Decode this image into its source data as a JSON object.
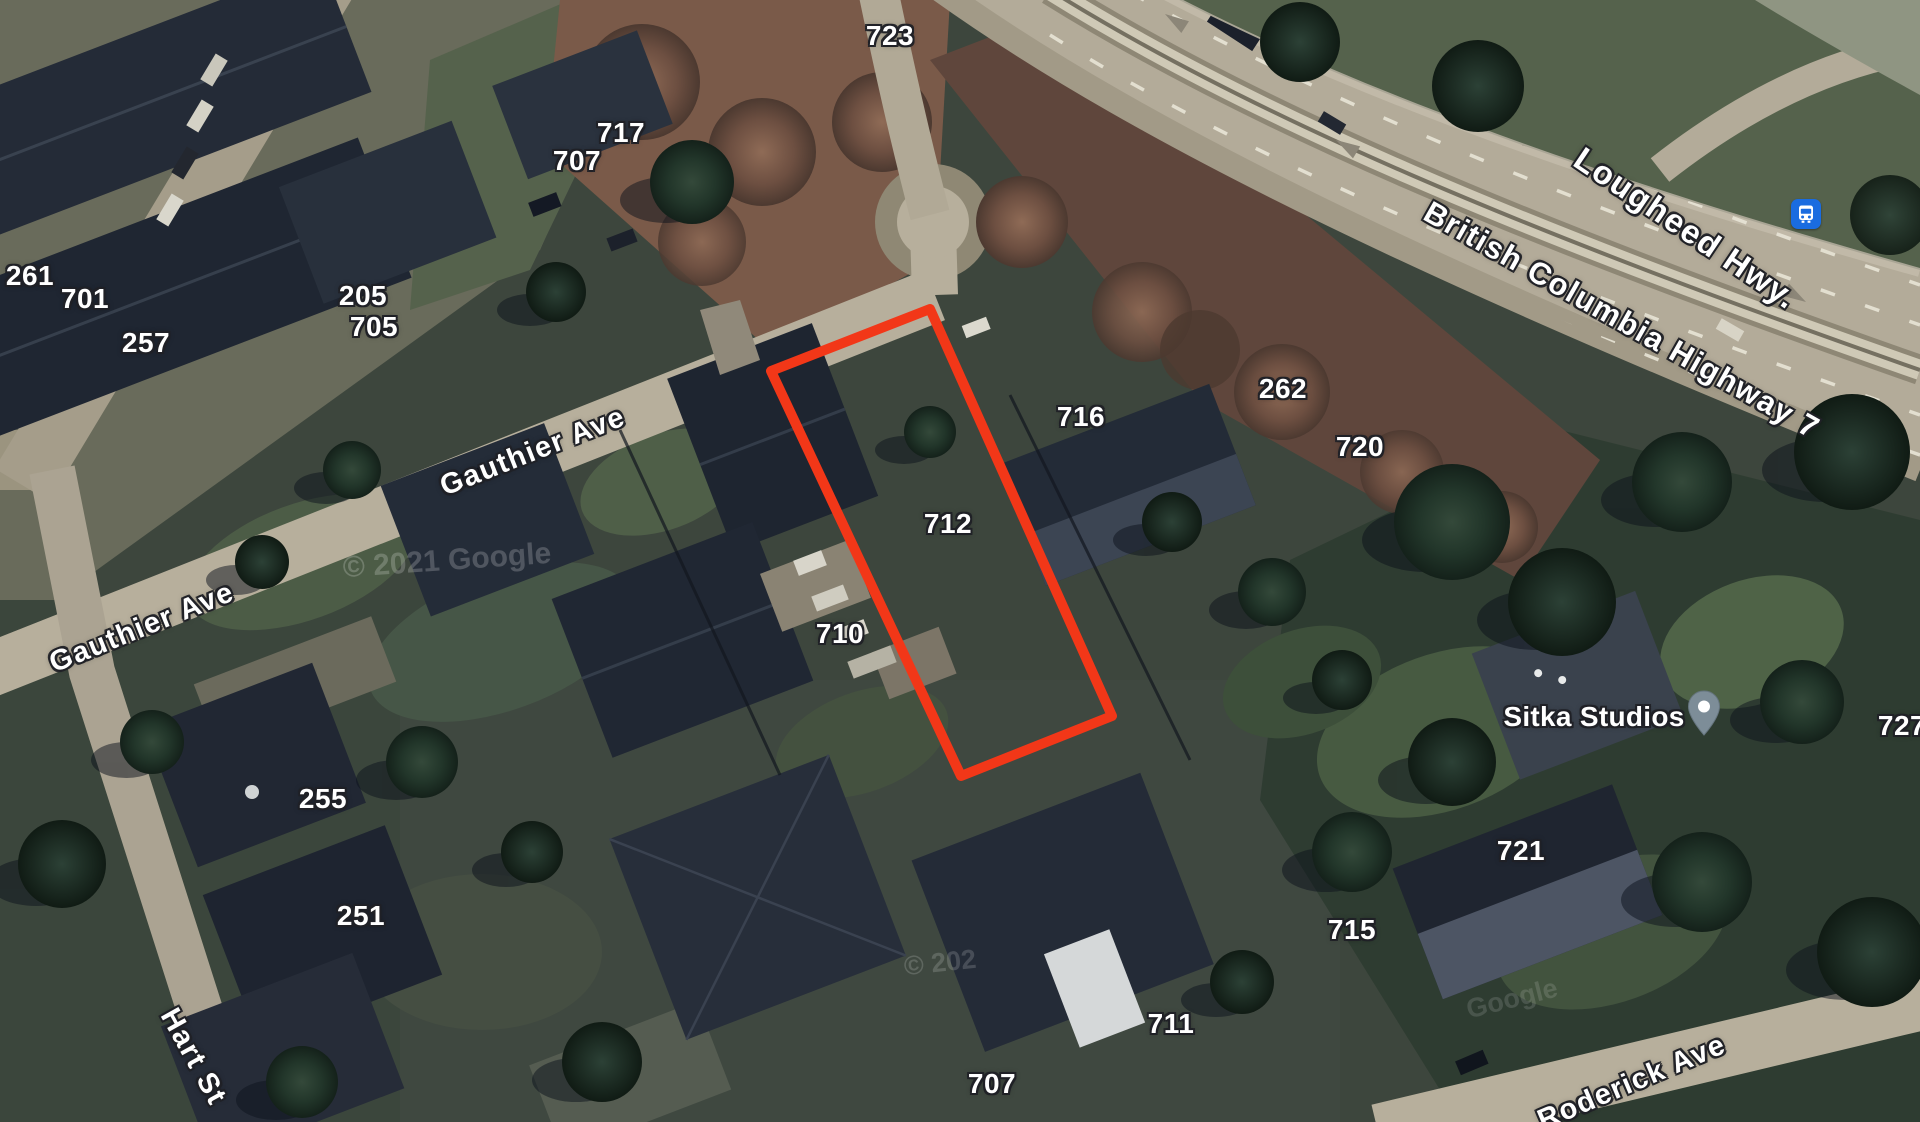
{
  "map": {
    "view_type": "satellite",
    "parcel": {
      "color": "#f23718",
      "points": "771,371 930,309 1112,716 961,776"
    },
    "labels": {
      "house_numbers": [
        {
          "text": "723",
          "x": 890,
          "y": 36
        },
        {
          "text": "717",
          "x": 621,
          "y": 133
        },
        {
          "text": "707",
          "x": 577,
          "y": 161
        },
        {
          "text": "261",
          "x": 30,
          "y": 276
        },
        {
          "text": "701",
          "x": 85,
          "y": 299
        },
        {
          "text": "257",
          "x": 146,
          "y": 343
        },
        {
          "text": "205",
          "x": 363,
          "y": 296
        },
        {
          "text": "705",
          "x": 374,
          "y": 327
        },
        {
          "text": "716",
          "x": 1081,
          "y": 417
        },
        {
          "text": "262",
          "x": 1283,
          "y": 389
        },
        {
          "text": "720",
          "x": 1360,
          "y": 447
        },
        {
          "text": "712",
          "x": 948,
          "y": 524
        },
        {
          "text": "710",
          "x": 840,
          "y": 634
        },
        {
          "text": "255",
          "x": 323,
          "y": 799
        },
        {
          "text": "251",
          "x": 361,
          "y": 916
        },
        {
          "text": "721",
          "x": 1521,
          "y": 851
        },
        {
          "text": "715",
          "x": 1352,
          "y": 930
        },
        {
          "text": "711",
          "x": 1171,
          "y": 1024
        },
        {
          "text": "707",
          "x": 992,
          "y": 1084
        },
        {
          "text": "727",
          "x": 1902,
          "y": 726
        }
      ],
      "streets": [
        {
          "text": "Gauthier Ave",
          "x": 533,
          "y": 452,
          "angle": -21.5,
          "size": 29
        },
        {
          "text": "Gauthier Ave",
          "x": 142,
          "y": 628,
          "angle": -22,
          "size": 29
        },
        {
          "text": "Hart St",
          "x": 193,
          "y": 1057,
          "angle": 61,
          "size": 29
        },
        {
          "text": "Roderick Ave",
          "x": 1632,
          "y": 1083,
          "angle": -23,
          "size": 29
        },
        {
          "text": "Lougheed Hwy.",
          "x": 1686,
          "y": 228,
          "angle": 34,
          "size": 33
        },
        {
          "text": "British Columbia Highway 7",
          "x": 1622,
          "y": 320,
          "angle": 29.5,
          "size": 31
        }
      ],
      "watermarks": [
        {
          "text": "© 2021 Google",
          "x": 447,
          "y": 561,
          "angle": -4,
          "opacity": 0.2,
          "size": 30
        },
        {
          "text": "© 202",
          "x": 940,
          "y": 963,
          "angle": -6,
          "opacity": 0.16,
          "size": 27
        },
        {
          "text": "Google",
          "x": 1512,
          "y": 999,
          "angle": -14,
          "opacity": 0.13,
          "size": 27
        }
      ]
    },
    "poi": {
      "name": "Sitka Studios",
      "label_x": 1594,
      "label_y": 717,
      "pin": {
        "x": 1704,
        "y": 714,
        "color": "#7d8d98"
      }
    },
    "transit": {
      "kind": "bus-stop",
      "x": 1806,
      "y": 214,
      "color": "#1a6ce0"
    }
  }
}
